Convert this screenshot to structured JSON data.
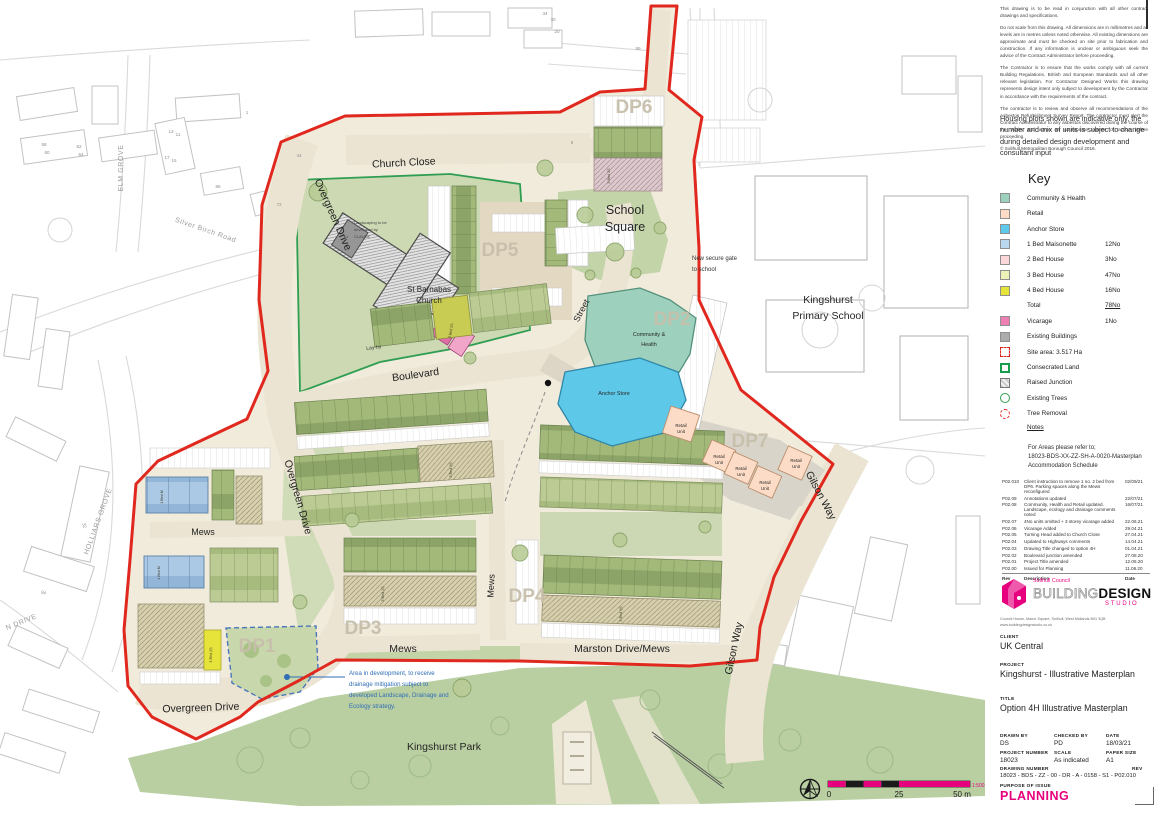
{
  "notes_top": {
    "p1": "This drawing is to be read in conjunction with all other contract drawings and specifications.",
    "p2": "Do not scale from this drawing. All dimensions are in millimetres and all levels are in metres unless noted otherwise. All existing dimensions are approximate and must be checked on site prior to fabrication and construction. If any information is unclear or ambiguous seek the advice of the Contract Administrator before proceeding.",
    "p3": "The Contractor is to ensure that the works comply with all current Building Regulations, British and European Standards and all other relevant legislation. For Contractor Designed Works this drawing represents design intent only subject to development by the Contractor in accordance with the requirements of the contract.",
    "p4": "The contractor is to review and observe all recommendations of the Asbestos Refurbishment Survey Report. The contractor must alert the Contract Administrator to any asbestos discovered during the course of the works and agree an appropriate course of action before proceeding.",
    "copyright": "©    Solihull Metropolitan Borough Council 2016."
  },
  "housing_note": "Housing plots shown are indicative only, the number and mix of units is subject to change during detailed design development and consultant input",
  "key": {
    "title": "Key",
    "items": [
      {
        "label": "Community & Health",
        "count": ""
      },
      {
        "label": "Retail",
        "count": ""
      },
      {
        "label": "Anchor Store",
        "count": ""
      },
      {
        "label": "1 Bed Maisonette",
        "count": "12No"
      },
      {
        "label": "2 Bed House",
        "count": "3No"
      },
      {
        "label": "3 Bed House",
        "count": "47No"
      },
      {
        "label": "4 Bed House",
        "count": "16No"
      }
    ],
    "total_label": "Total",
    "total_value": "78No",
    "items2": [
      {
        "label": "Vicarage",
        "count": "1No"
      },
      {
        "label": "Existing Buildings",
        "count": ""
      },
      {
        "label": "Site area: 3.517 Ha",
        "count": ""
      },
      {
        "label": "Consecrated Land",
        "count": ""
      },
      {
        "label": "Raised Junction",
        "count": ""
      },
      {
        "label": "Existing Trees",
        "count": ""
      },
      {
        "label": "Tree Removal",
        "count": ""
      }
    ],
    "notes_link": "Notes"
  },
  "notes_section": {
    "line1": "For Areas please refer to;",
    "line2": "18023-BDS-XX-ZZ-SH-A-0020-Masterplan",
    "line3": "Accommodation Schedule"
  },
  "revisions": {
    "header": {
      "rev": "Rev",
      "desc": "Description",
      "date": "Date"
    },
    "rows": [
      {
        "rev": "P02.010",
        "desc": "Client instruction to remove 1 no. 2 bed from DP6. Parking spaces along the Mews reconfigured",
        "date": "02/09/21"
      },
      {
        "rev": "P02.09",
        "desc": "Annotations updated",
        "date": "22/07/21"
      },
      {
        "rev": "P02.08",
        "desc": "Community, Health and Retail updated. Landscape, ecology and drainage comments noted",
        "date": "16/07/21"
      },
      {
        "rev": "P02.07",
        "desc": "4No units omitted + 3 storey vicarage added",
        "date": "22.06.21"
      },
      {
        "rev": "P02.06",
        "desc": "Vicarage Added",
        "date": "29.04.21"
      },
      {
        "rev": "P02.05",
        "desc": "Turning Head added to Church Close",
        "date": "27.04.21"
      },
      {
        "rev": "P02.04",
        "desc": "Updated to Highways comments",
        "date": "14.04.21"
      },
      {
        "rev": "P02.03",
        "desc": "Drawing Title changed to option 4H",
        "date": "01.04.21"
      },
      {
        "rev": "P02.02",
        "desc": "Boulevard junction amended",
        "date": "27.08.20"
      },
      {
        "rev": "P02.01",
        "desc": "Project Title amended",
        "date": "12.06.20"
      },
      {
        "rev": "P02.00",
        "desc": "Issued for Planning",
        "date": "11.06.20"
      }
    ]
  },
  "logo": {
    "council": "Solihull Council",
    "word1": "BUILDING",
    "word2": "DESIGN",
    "word3": "STUDIO",
    "address": "Council House, Manor Square, Solihull, West Midlands B91 3QB",
    "web": "www.buildingdesignstudio.co.uk"
  },
  "title_block": {
    "client_label": "CLIENT",
    "client": "UK Central",
    "project_label": "PROJECT",
    "project": "Kingshurst - Illustrative Masterplan",
    "title_label": "TITLE",
    "title": "Option 4H Illustrative Masterplan",
    "drawn_label": "DRAWN BY",
    "drawn": "DS",
    "checked_label": "CHECKED BY",
    "checked": "PD",
    "date_label": "DATE",
    "date": "18/03/21",
    "projnum_label": "PROJECT NUMBER",
    "projnum": "18023",
    "scale_label": "SCALE",
    "scale": "As indicated",
    "paper_label": "PAPER SIZE",
    "paper": "A1",
    "dwgnum_label": "DRAWING NUMBER",
    "dwgnum": "18023 - BDS - ZZ - 00 - DR - A - 0158 - S1 - P02.010",
    "rev_label": "REV",
    "purpose_label": "PURPOSE OF ISSUE",
    "purpose": "PLANNING"
  },
  "map": {
    "streets": {
      "elm": "ELM GROVE",
      "silver": "Silver Birch Road",
      "holliars": "HOLLIARS GROVE",
      "ndrive": "N DRIVE",
      "church_close": "Church Close",
      "overgreen1": "Overgreen Drive",
      "overgreen2": "Overgreen Drive",
      "overgreen3": "Overgreen Drive",
      "boulevard": "Boulevard",
      "street": "Street",
      "layby": "Lay-by",
      "mews1": "Mews",
      "mews2": "Mews",
      "mews3": "Mews",
      "marston": "Marston Drive/Mews",
      "gilson1": "Gilson Way",
      "gilson2": "Gilson Way"
    },
    "places": {
      "school_sq1": "School",
      "school_sq2": "Square",
      "park": "Kingshurst Park",
      "school1": "Kingshurst",
      "school2": "Primary School",
      "church1": "St Barnabas",
      "church2": "Church",
      "community1": "Community &",
      "community2": "Health",
      "anchor": "Anchor Store",
      "retail1": "Retail",
      "retail2": "Unit"
    },
    "dp": {
      "dp1": "DP1",
      "dp2": "DP2",
      "dp3": "DP3",
      "dp4": "DP4",
      "dp5": "DP5",
      "dp6": "DP6",
      "dp7": "DP7"
    },
    "annotations": {
      "gate1": "New secure gate",
      "gate2": "to school",
      "land1": "Landscaping to be",
      "land2": "developed by",
      "land3": "CLAUDE",
      "area1": "Area in development, to receive",
      "area2": "drainage mitigation subject to",
      "area3": "developed Landscape, Drainage and",
      "area4": "Ecology strategy."
    },
    "plots": {
      "bed1": "1 Bed M",
      "bed3": "3 Bed 2S",
      "bed4": "4 Bed 2S"
    },
    "numbers": [
      "1",
      "58",
      "60",
      "62",
      "64",
      "13",
      "11",
      "17",
      "15",
      "86",
      "72",
      "44",
      "34",
      "30",
      "20",
      "99",
      "32",
      "94",
      "6"
    ],
    "scalebar": {
      "zero": "0",
      "mid": "25",
      "end": "50 m",
      "ratio": "1:500"
    }
  },
  "colors": {
    "brand_pink": "#e6007e",
    "boundary_red": "#e0281e",
    "community": "#9ed1bd",
    "retail": "#fcdcc6",
    "anchor": "#5ec8e8",
    "bed1": "#b9d7ee",
    "bed2": "#fcd7da",
    "bed3": "#eef0b9",
    "bed4": "#e6e33b",
    "vicarage": "#ef7eb4",
    "existing": "#ababab",
    "consecrated": "#169c4e",
    "annotation_blue": "#2f6db5"
  }
}
